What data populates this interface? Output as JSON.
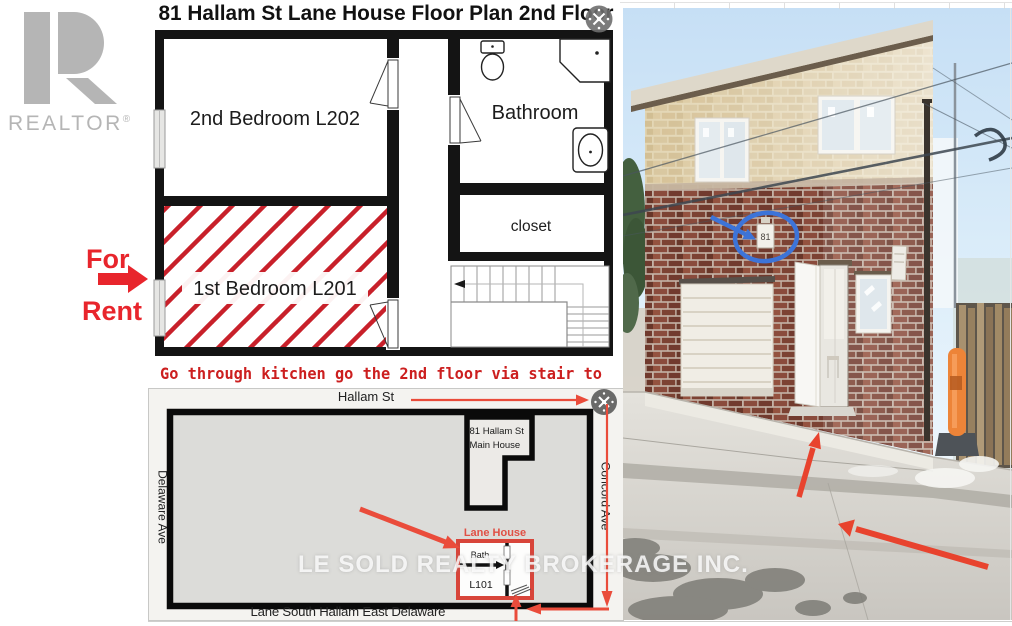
{
  "branding": {
    "logo_text": "REALTOR",
    "registered": "®"
  },
  "for_rent": {
    "line1": "For",
    "line2": "Rent"
  },
  "floor_plan": {
    "title": "81 Hallam St Lane House Floor Plan 2nd Floor",
    "bedroom2": "2nd Bedroom L202",
    "bedroom1": "1st Bedroom L201",
    "bathroom": "Bathroom",
    "closet": "closet"
  },
  "note": "Go through kitchen go the 2nd floor via stair to",
  "site_map": {
    "street_top": "Hallam St",
    "street_left": "Delaware Ave",
    "street_right": "Concord Ave",
    "street_bottom": "Lane South Hallam East Delaware",
    "main_house_line1": "81 Hallam St",
    "main_house_line2": "Main House",
    "lane_house": "Lane House",
    "bath": "Bath",
    "unit": "L101"
  },
  "photo": {
    "address_plaque": "81"
  },
  "watermark": "LE SOLD REALTY BROKERAGE INC.",
  "colors": {
    "for_rent_red": "#e8252c",
    "hatch_red": "#c8202a",
    "note_red": "#cc1f1f",
    "annotation_red": "#ea4c3b",
    "annotation_blue": "#3d74d8",
    "logo_gray": "#b5b5b5",
    "wall_black": "#141414"
  }
}
